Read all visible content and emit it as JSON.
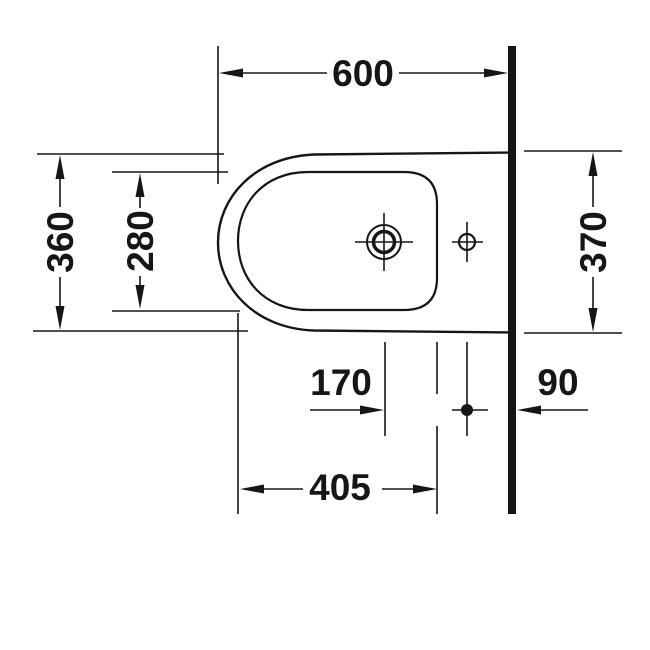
{
  "drawing": {
    "background": "#ffffff",
    "ink_color": "#161616"
  },
  "dimensions": {
    "depth_total": "600",
    "width_front": "360",
    "bowl_width": "280",
    "width_at_wall": "370",
    "tap_to_fixing_hole": "170",
    "fixing_hole_to_wall": "90",
    "bowl_length": "405"
  }
}
